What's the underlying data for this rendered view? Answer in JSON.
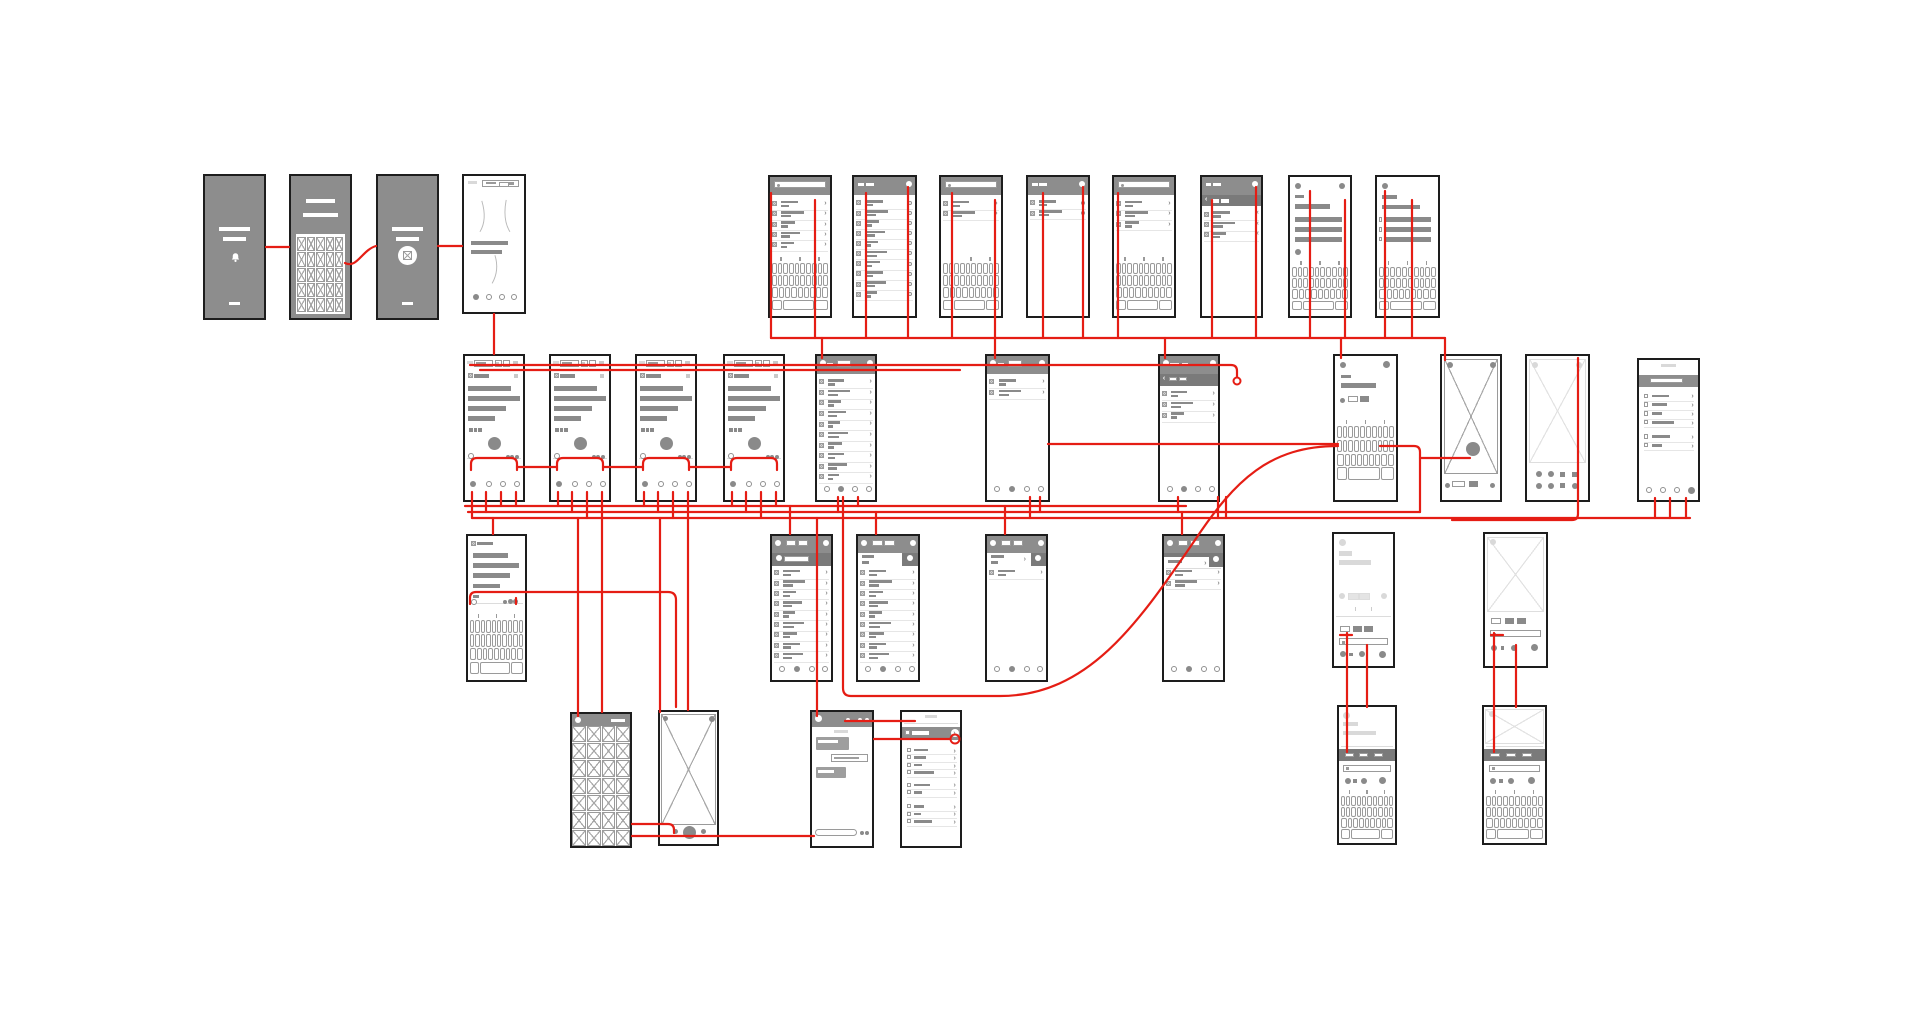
{
  "canvas": {
    "width": 1920,
    "height": 1020,
    "background": "#ffffff"
  },
  "colors": {
    "connector": "#e51d14",
    "phone_border": "#1d1d1d",
    "dark_fill": "#8d8d8d",
    "band_fill": "#7a7a7a",
    "bar": "#8a8a8a",
    "bar_light": "#d9d9d9",
    "white": "#ffffff",
    "key_border": "#9a9a9a",
    "hairline": "#e6e6e6"
  },
  "screens": [
    {
      "id": "splash-a",
      "name": "dark-splash-screen-1",
      "type": "splash",
      "icon": "bell",
      "x": 203,
      "y": 174,
      "w": 63,
      "h": 146
    },
    {
      "id": "dark-grid",
      "name": "dark-image-grid-screen",
      "type": "darkgrid",
      "x": 289,
      "y": 174,
      "w": 63,
      "h": 146
    },
    {
      "id": "splash-b",
      "name": "dark-splash-screen-2",
      "type": "splash",
      "icon": "image",
      "x": 376,
      "y": 174,
      "w": 63,
      "h": 146
    },
    {
      "id": "onboarding",
      "name": "onboarding-walkthrough-screen",
      "type": "onboard",
      "x": 462,
      "y": 174,
      "w": 64,
      "h": 140
    },
    {
      "id": "search-a",
      "name": "search-keyboard-screen-1",
      "type": "searchkb",
      "n": 5,
      "x": 768,
      "y": 175,
      "w": 64,
      "h": 143
    },
    {
      "id": "check-a",
      "name": "checklist-screen-long",
      "type": "checklist",
      "n": 10,
      "x": 852,
      "y": 175,
      "w": 65,
      "h": 143
    },
    {
      "id": "search-b",
      "name": "search-keyboard-screen-2",
      "type": "searchkb",
      "n": 2,
      "x": 939,
      "y": 175,
      "w": 64,
      "h": 143
    },
    {
      "id": "check-b",
      "name": "checklist-screen-short",
      "type": "checklist",
      "n": 2,
      "x": 1026,
      "y": 175,
      "w": 64,
      "h": 143
    },
    {
      "id": "search-c",
      "name": "search-keyboard-screen-3",
      "type": "searchkb",
      "n": 3,
      "x": 1112,
      "y": 175,
      "w": 64,
      "h": 143
    },
    {
      "id": "sublist",
      "name": "sublist-back-screen",
      "type": "sublistback",
      "n": 3,
      "x": 1200,
      "y": 175,
      "w": 63,
      "h": 143
    },
    {
      "id": "compose-a",
      "name": "compose-keyboard-screen-1",
      "type": "composekb",
      "variant": "a",
      "x": 1288,
      "y": 175,
      "w": 64,
      "h": 143
    },
    {
      "id": "compose-b",
      "name": "compose-keyboard-screen-2",
      "type": "composekb",
      "variant": "b",
      "x": 1375,
      "y": 175,
      "w": 65,
      "h": 143
    },
    {
      "id": "article-a",
      "name": "article-screen-1",
      "type": "article",
      "x": 463,
      "y": 354,
      "w": 62,
      "h": 148
    },
    {
      "id": "article-b",
      "name": "article-screen-2",
      "type": "article",
      "x": 549,
      "y": 354,
      "w": 62,
      "h": 148
    },
    {
      "id": "article-c",
      "name": "article-screen-3",
      "type": "article",
      "x": 635,
      "y": 354,
      "w": 62,
      "h": 148
    },
    {
      "id": "article-d",
      "name": "article-screen-4",
      "type": "article",
      "x": 723,
      "y": 354,
      "w": 62,
      "h": 148
    },
    {
      "id": "feed-a",
      "name": "feed-list-screen-long",
      "type": "feed",
      "n": 10,
      "x": 815,
      "y": 354,
      "w": 62,
      "h": 148
    },
    {
      "id": "feed-b",
      "name": "feed-list-screen-short",
      "type": "feed",
      "n": 2,
      "x": 985,
      "y": 354,
      "w": 65,
      "h": 148
    },
    {
      "id": "feed-sub",
      "name": "feed-sublist-screen",
      "type": "feedsub",
      "n": 3,
      "x": 1158,
      "y": 354,
      "w": 62,
      "h": 148
    },
    {
      "id": "compose-c",
      "name": "compose-keyboard-screen-3",
      "type": "composekb2",
      "x": 1333,
      "y": 354,
      "w": 65,
      "h": 148
    },
    {
      "id": "photo-a",
      "name": "photo-placeholder-screen-1",
      "type": "photoxa",
      "x": 1440,
      "y": 354,
      "w": 62,
      "h": 148
    },
    {
      "id": "photo-b",
      "name": "photo-placeholder-screen-2",
      "type": "photoxb",
      "x": 1525,
      "y": 354,
      "w": 65,
      "h": 148
    },
    {
      "id": "settings-a",
      "name": "settings-list-screen-right",
      "type": "settingsA",
      "x": 1637,
      "y": 358,
      "w": 63,
      "h": 144
    },
    {
      "id": "article-kb",
      "name": "article-keyboard-screen",
      "type": "articlekb",
      "x": 466,
      "y": 534,
      "w": 61,
      "h": 148
    },
    {
      "id": "tab-a",
      "name": "tab-list-screen-1",
      "type": "tablist",
      "variant": "a",
      "n": 9,
      "x": 770,
      "y": 534,
      "w": 63,
      "h": 148
    },
    {
      "id": "tab-b",
      "name": "tab-list-screen-2",
      "type": "tablist",
      "variant": "b",
      "n": 9,
      "x": 856,
      "y": 534,
      "w": 64,
      "h": 148
    },
    {
      "id": "tab-c",
      "name": "tab-list-screen-3",
      "type": "tablist",
      "variant": "c",
      "n": 1,
      "x": 985,
      "y": 534,
      "w": 63,
      "h": 148
    },
    {
      "id": "tab-d",
      "name": "tab-list-screen-4",
      "type": "tablist",
      "variant": "d",
      "n": 2,
      "x": 1162,
      "y": 534,
      "w": 63,
      "h": 148
    },
    {
      "id": "faded-compose",
      "name": "faded-compose-screen",
      "type": "fadedcompose",
      "x": 1332,
      "y": 532,
      "w": 63,
      "h": 136
    },
    {
      "id": "photo-detail",
      "name": "photo-detail-compose-screen",
      "type": "photodetail",
      "x": 1483,
      "y": 532,
      "w": 65,
      "h": 136
    },
    {
      "id": "gallery",
      "name": "gallery-grid-screen",
      "type": "gallery",
      "x": 570,
      "y": 712,
      "w": 62,
      "h": 136
    },
    {
      "id": "camera",
      "name": "camera-capture-screen",
      "type": "camera",
      "x": 658,
      "y": 710,
      "w": 61,
      "h": 136
    },
    {
      "id": "chat",
      "name": "chat-conversation-screen",
      "type": "chat",
      "x": 810,
      "y": 710,
      "w": 64,
      "h": 138
    },
    {
      "id": "settings-b",
      "name": "settings-list-screen-bottom",
      "type": "settingsB",
      "x": 900,
      "y": 710,
      "w": 62,
      "h": 138
    },
    {
      "id": "kbtabs-a",
      "name": "tabbed-keyboard-screen-1",
      "type": "kbtabs",
      "variant": "a",
      "x": 1337,
      "y": 705,
      "w": 60,
      "h": 140
    },
    {
      "id": "kbtabs-b",
      "name": "tabbed-keyboard-screen-2",
      "type": "kbtabs",
      "variant": "b",
      "x": 1482,
      "y": 705,
      "w": 65,
      "h": 140
    }
  ],
  "connectors": [
    "M266,247 H289",
    "M345,263 C357,269 362,250 376,246",
    "M438,246 H462",
    "M494,314 V354",
    "M470,365 H1210",
    "M480,370 H960",
    "M1210,365 H1231 Q1237,365 1237,371 V377",
    "M771,193 V338",
    "M815,200 V338",
    "M866,193 V338",
    "M908,187 V338",
    "M952,193 V338",
    "M995,200 V358",
    "M1043,193 V338",
    "M1083,187 V338",
    "M1118,193 V338",
    "M1212,200 V338",
    "M1256,187 V338",
    "M1310,191 V338",
    "M1345,200 V338",
    "M1385,191 V338",
    "M1412,200 V338",
    "M771,338 H1445",
    "M822,338 V358",
    "M1165,338 V358",
    "M1341,338 V358",
    "M1445,338 V360",
    "M1578,358 V514 Q1578,520 1572,520 H1452",
    "M471,470 V464 Q471,458 477,458 H511 Q517,458 517,464 V470",
    "M557,470 V464 Q557,458 563,458 H597 Q603,458 603,464 V470",
    "M643,470 V464 Q643,458 649,458 H683 Q689,458 689,464 V470",
    "M731,470 V464 Q731,458 737,458 H771 Q777,458 777,464 V470",
    "M517,467 H557",
    "M603,467 H643",
    "M689,467 H731",
    "M472,492 V518",
    "M486,492 V512",
    "M501,492 V506",
    "M516,492 V506",
    "M558,492 V506",
    "M572,492 V512",
    "M587,492 V518",
    "M602,492 V712",
    "M644,492 V506",
    "M658,492 V512",
    "M673,492 V518",
    "M688,492 V710",
    "M732,492 V506",
    "M746,492 V512",
    "M761,492 V518",
    "M776,492 V506",
    "M465,506 H1186",
    "M468,512 H1420",
    "M472,518 H1690",
    "M790,506 V534",
    "M876,512 V534",
    "M1005,506 V534",
    "M1182,512 V534",
    "M493,518 V534",
    "M838,497 V512",
    "M858,497 V506",
    "M1030,497 V518",
    "M1040,497 V512",
    "M1178,497 V512",
    "M1218,497 V518",
    "M1226,497 V518",
    "M1655,498 V518",
    "M1670,498 V518",
    "M1686,498 V518",
    "M578,518 V716",
    "M660,518 V712",
    "M817,518 V716",
    "M843,497 V688 Q843,696 851,696 H1000 C1090,696 1140,620 1195,540 C1235,480 1270,446 1338,446",
    "M1048,444 H1338",
    "M1380,446 H1414 Q1420,446 1420,452 V512",
    "M1470,458 H1420",
    "M1340,635 H1352",
    "M1491,635 H1503",
    "M1347,633 V752",
    "M1367,645 V707",
    "M1494,633 V752",
    "M1516,645 V707",
    "M845,721 H915",
    "M874,739 H949",
    "M632,824 H668 Q674,824 674,830 V833",
    "M632,836 H814",
    "M470,604 V598 Q470,592 476,592 H668 Q676,592 676,600 V707",
    "M516,598 V604"
  ],
  "rings": [
    {
      "cx": 955,
      "cy": 739,
      "r": 4.5
    },
    {
      "cx": 1237,
      "cy": 381,
      "r": 3.5
    }
  ]
}
